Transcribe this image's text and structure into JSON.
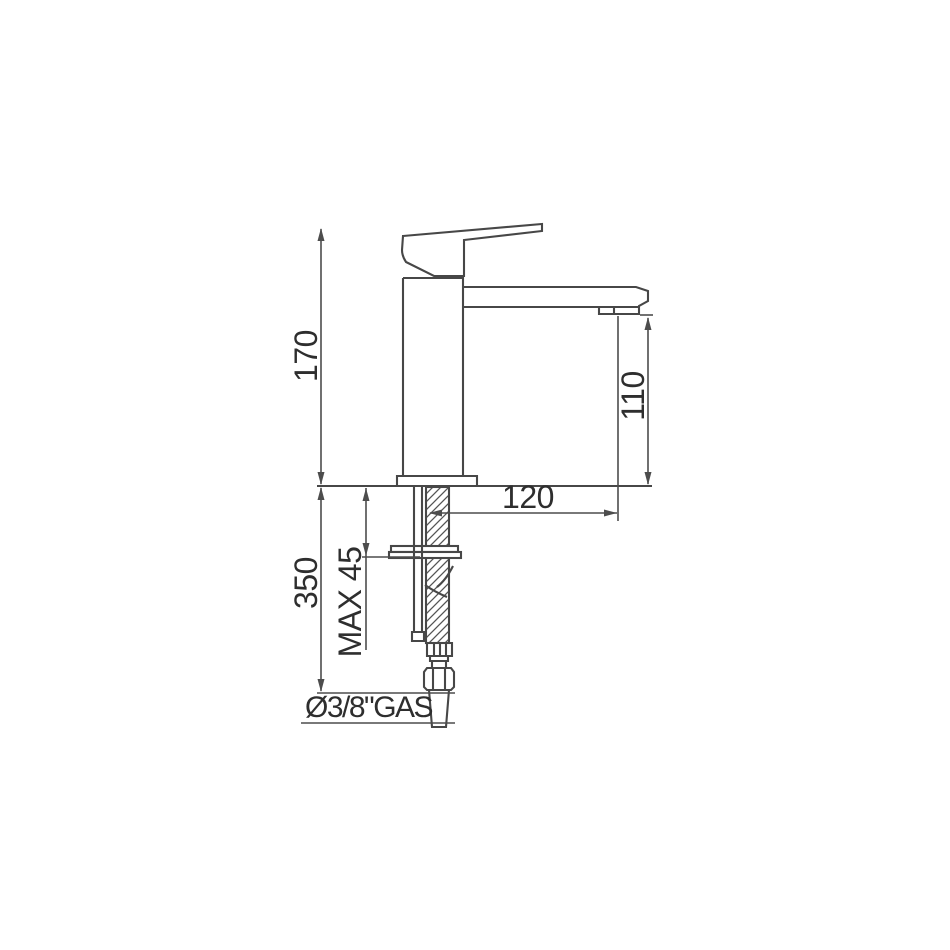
{
  "drawing": {
    "background": "#ffffff",
    "line_color": "#474747",
    "text_color": "#2e2e2e",
    "dimensions": {
      "total_height": "170",
      "spout_outlet_height": "110",
      "spout_reach": "120",
      "under_counter_length": "350",
      "max_counter_thickness": "MAX 45",
      "supply_connection": "Ø3/8\"GAS"
    }
  }
}
